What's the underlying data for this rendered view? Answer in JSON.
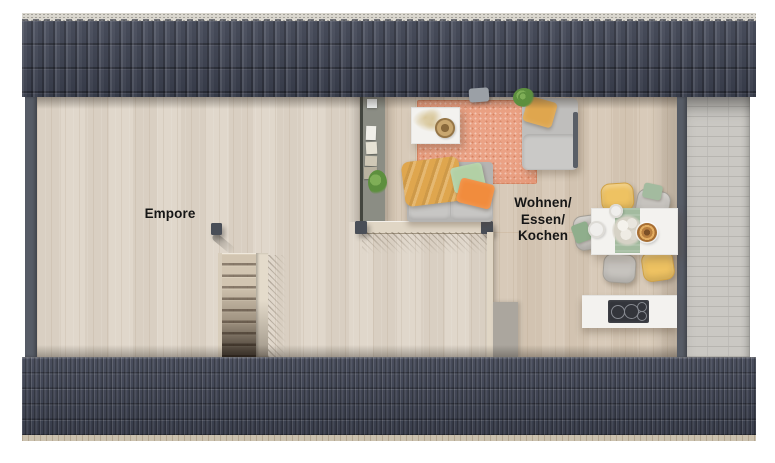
{
  "labels": {
    "empore": "Empore",
    "living_line1": "Wohnen/",
    "living_line2": "Essen/",
    "living_line3": "Kochen"
  },
  "colors": {
    "roof": "#3f4454",
    "ridge_cap": "#dad7cf",
    "eave": "#cbc1ae",
    "wall": "#575c66",
    "floor": "#ded5c8",
    "floor_warm_tint": "rgba(173,138,94,0.16)",
    "wood_grain": "rgba(150,125,95,0.12)",
    "partition": "#8b8d84",
    "knee_wall": "#e0d6c5",
    "post": "#494e57",
    "stair_tread": "#d2c5b1",
    "rug": "#eba285",
    "sofa": "#b5b4b2",
    "cushion": "#c7c6c4",
    "mustard": "#dfa64e",
    "pillow_green": "#b2d0a5",
    "pillow_orange": "#f18c3d",
    "daybed": "#bfbebc",
    "chair_yellow": "#eec262",
    "chair_gray": "#c6c3be",
    "sage": "#a3bb9f",
    "white_furniture": "#f3f2ef",
    "cooktop": "#33353b",
    "tile": "#cac8c3",
    "grout": "#b7b5b0",
    "text": "#161616"
  }
}
